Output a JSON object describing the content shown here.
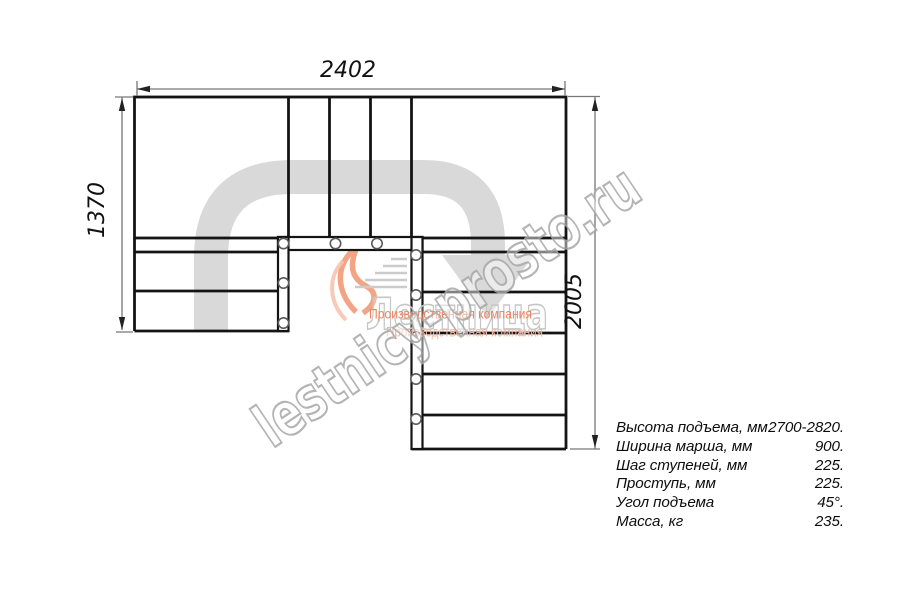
{
  "dimensions": {
    "width_top": "2402",
    "height_left": "1370",
    "height_right": "2005"
  },
  "specs": {
    "rows": [
      {
        "label": "Высота подъема, мм",
        "value": "2700-2820."
      },
      {
        "label": "Ширина марша, мм",
        "value": "900."
      },
      {
        "label": "Шаг ступеней, мм",
        "value": "225."
      },
      {
        "label": "Проступь, мм",
        "value": "225."
      },
      {
        "label": "Угол подъема",
        "value": "45°."
      },
      {
        "label": "Масса, кг",
        "value": "235."
      }
    ]
  },
  "watermarks": {
    "site": "lestnicy-prosto.ru",
    "brand": "Лестница",
    "tagline_line1": "Производственная компания",
    "tagline_line2": "Производственная компания"
  },
  "colors": {
    "structure_line": "#141414",
    "dimension_line": "#777777",
    "arrow_fill": "#d9d9d9",
    "watermark_outline": "#a8a8a8",
    "logo_accent": "#f19a78",
    "tagline_text": "#ee8361"
  }
}
